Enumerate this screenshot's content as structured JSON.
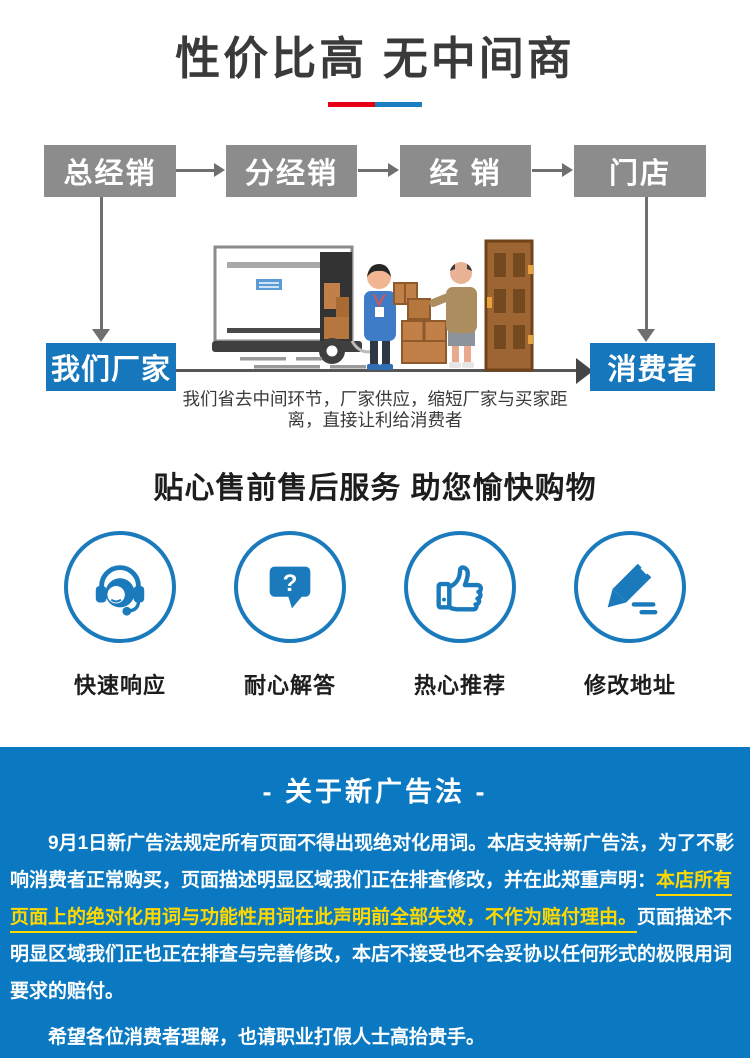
{
  "hero": {
    "title": "性价比高 无中间商",
    "underline_red": "#e60012",
    "underline_blue": "#1b7ec2"
  },
  "flow": {
    "top_boxes": [
      "总经销",
      "分经销",
      "经 销",
      "门店"
    ],
    "bottom_left": "我们厂家",
    "bottom_right": "消费者",
    "caption_lines": [
      "我们省去中间环节，厂家供应，缩短厂家与买家距",
      "离，直接让利给消费者"
    ],
    "gray_box_color": "#8c8c8c",
    "blue_box_color": "#1677bd",
    "arrow_color": "#6f6f6f"
  },
  "services": {
    "title": "贴心售前售后服务 助您愉快购物",
    "accent_color": "#1a7abc",
    "items": [
      {
        "icon": "headset-icon",
        "label": "快速响应"
      },
      {
        "icon": "question-bubble-icon",
        "label": "耐心解答",
        "glyph": "?"
      },
      {
        "icon": "thumbs-up-icon",
        "label": "热心推荐"
      },
      {
        "icon": "pencil-icon",
        "label": "修改地址"
      }
    ]
  },
  "notice": {
    "bg_color": "#0a79c1",
    "highlight_color": "#ffd800",
    "title": "- 关于新广告法 -",
    "lines": [
      {
        "segments": [
          {
            "text": "9月1日新广告法规定所有页面不得出现绝对化用词。本店支持新广告法，为了不影"
          }
        ]
      },
      {
        "segments": [
          {
            "text": "响消费者正常购买，页面描述明显区域我们正在排查修改，并在此郑重声明："
          },
          {
            "text": "本店所有"
          }
        ]
      },
      {
        "segments": [
          {
            "text": "页面上的绝对化用词与功能性用词在此声明前全部失效，不作为赔付理由。"
          },
          {
            "text": "页面描述不"
          }
        ]
      },
      {
        "segments": [
          {
            "text": "明显区域我们正也正在排查与完善修改，本店不接受也不会妥协以任何形式的极限用词"
          }
        ]
      },
      {
        "segments": [
          {
            "text": "要求的赔付。"
          }
        ]
      },
      {
        "segments": [
          {
            "text": "希望各位消费者理解，也请职业打假人士高抬贵手。"
          }
        ]
      }
    ]
  }
}
